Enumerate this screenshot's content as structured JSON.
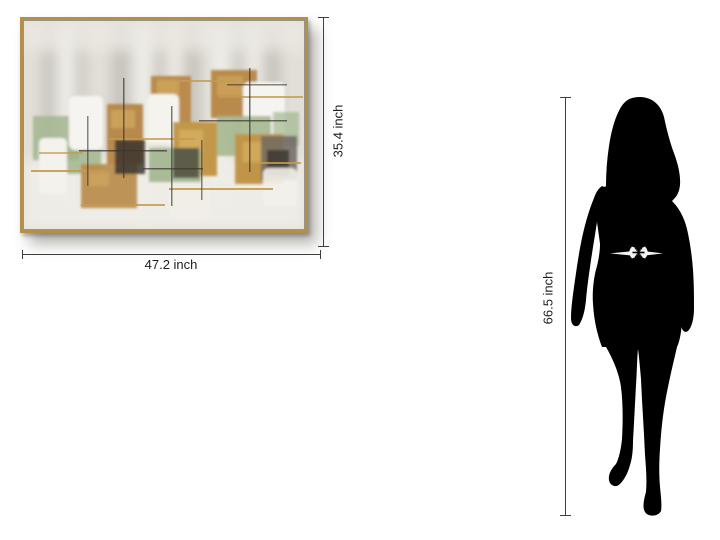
{
  "page": {
    "background_color": "#ffffff"
  },
  "artwork": {
    "type": "framed abstract canvas painting",
    "frame_color": "#b2904a",
    "width_label": "47.2 inch",
    "height_label": "35.4 inch",
    "canvas_colors": {
      "background": "#e2dfd8",
      "white_blocks": "#f5f3ee",
      "gold": "#ba8b4d",
      "gold_foil": "#d2ab5f",
      "green": "#a3b68f",
      "dark_accents": "#3a352e",
      "gray": "#6f6961"
    }
  },
  "figure": {
    "type": "woman silhouette",
    "color": "#000000",
    "height_label": "66.5 inch",
    "belt_accent_color": "#ffffff"
  },
  "dimension_lines": {
    "color": "#3f3f3f"
  }
}
